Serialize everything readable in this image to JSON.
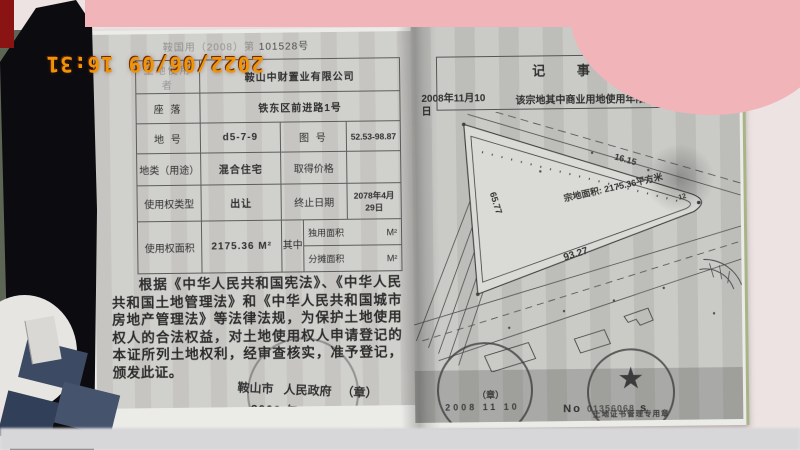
{
  "photo": {
    "timestamp": "2022/06/09 16:31",
    "accent_colors": {
      "timestamp_orange": "#ef9408",
      "pink_object": "#f1b4b9",
      "page_gray": "#cecdca"
    }
  },
  "left_page": {
    "header_prefix": "鞍国用（2008）第",
    "header_number": "101528号",
    "table": {
      "rows": [
        {
          "label": "土地使用者",
          "value": "鞍山中财置业有限公司"
        },
        {
          "label": "座  落",
          "value": "铁东区前进路1号"
        },
        {
          "label": "地  号",
          "value": "d5-7-9",
          "label2": "图  号",
          "value2": "52.53-98.87"
        },
        {
          "label": "地类（用途）",
          "value": "混合住宅",
          "label2": "取得价格",
          "value2": ""
        },
        {
          "label": "使用权类型",
          "value": "出让",
          "label2": "终止日期",
          "value2": "2078年4月29日"
        },
        {
          "label": "使用权面积",
          "value": "2175.36 M²",
          "label2": "其中",
          "subs": [
            {
              "label": "独用面积",
              "unit": "M²"
            },
            {
              "label": "分摊面积",
              "unit": "M²"
            }
          ]
        }
      ]
    },
    "paragraph": "根据《中华人民共和国宪法》、《中华人民共和国土地管理法》和《中华人民共和国城市房地产管理法》等法律法规，为保护土地使用权人的合法权益，对土地使用权人申请登记的本证所列土地权利，经审查核实，准予登记，颁发此证。",
    "issuer": {
      "city": "鞍山市",
      "gov": "人民政府",
      "seal_mark": "（章）",
      "date": "2008 年 11 月 10 日"
    }
  },
  "right_page": {
    "notes_title": "记  事",
    "note_date": "2008年11月10日",
    "note_text": "该宗地其中商业用地使用年限为40年。",
    "map": {
      "area_label": "宗地面积: 2175.36平方米",
      "dim_left": "65.77",
      "dim_top": "16.15",
      "dim_bottom": "93.27",
      "corner_point": "12"
    },
    "seal_left": {
      "mark": "（章）",
      "date": "2008 11 10"
    },
    "seal_right": {
      "star": "★",
      "ring_text": "土地证书管理专用章"
    },
    "serial": {
      "prefix": "No",
      "number": "01356068",
      "suffix": "s"
    }
  }
}
